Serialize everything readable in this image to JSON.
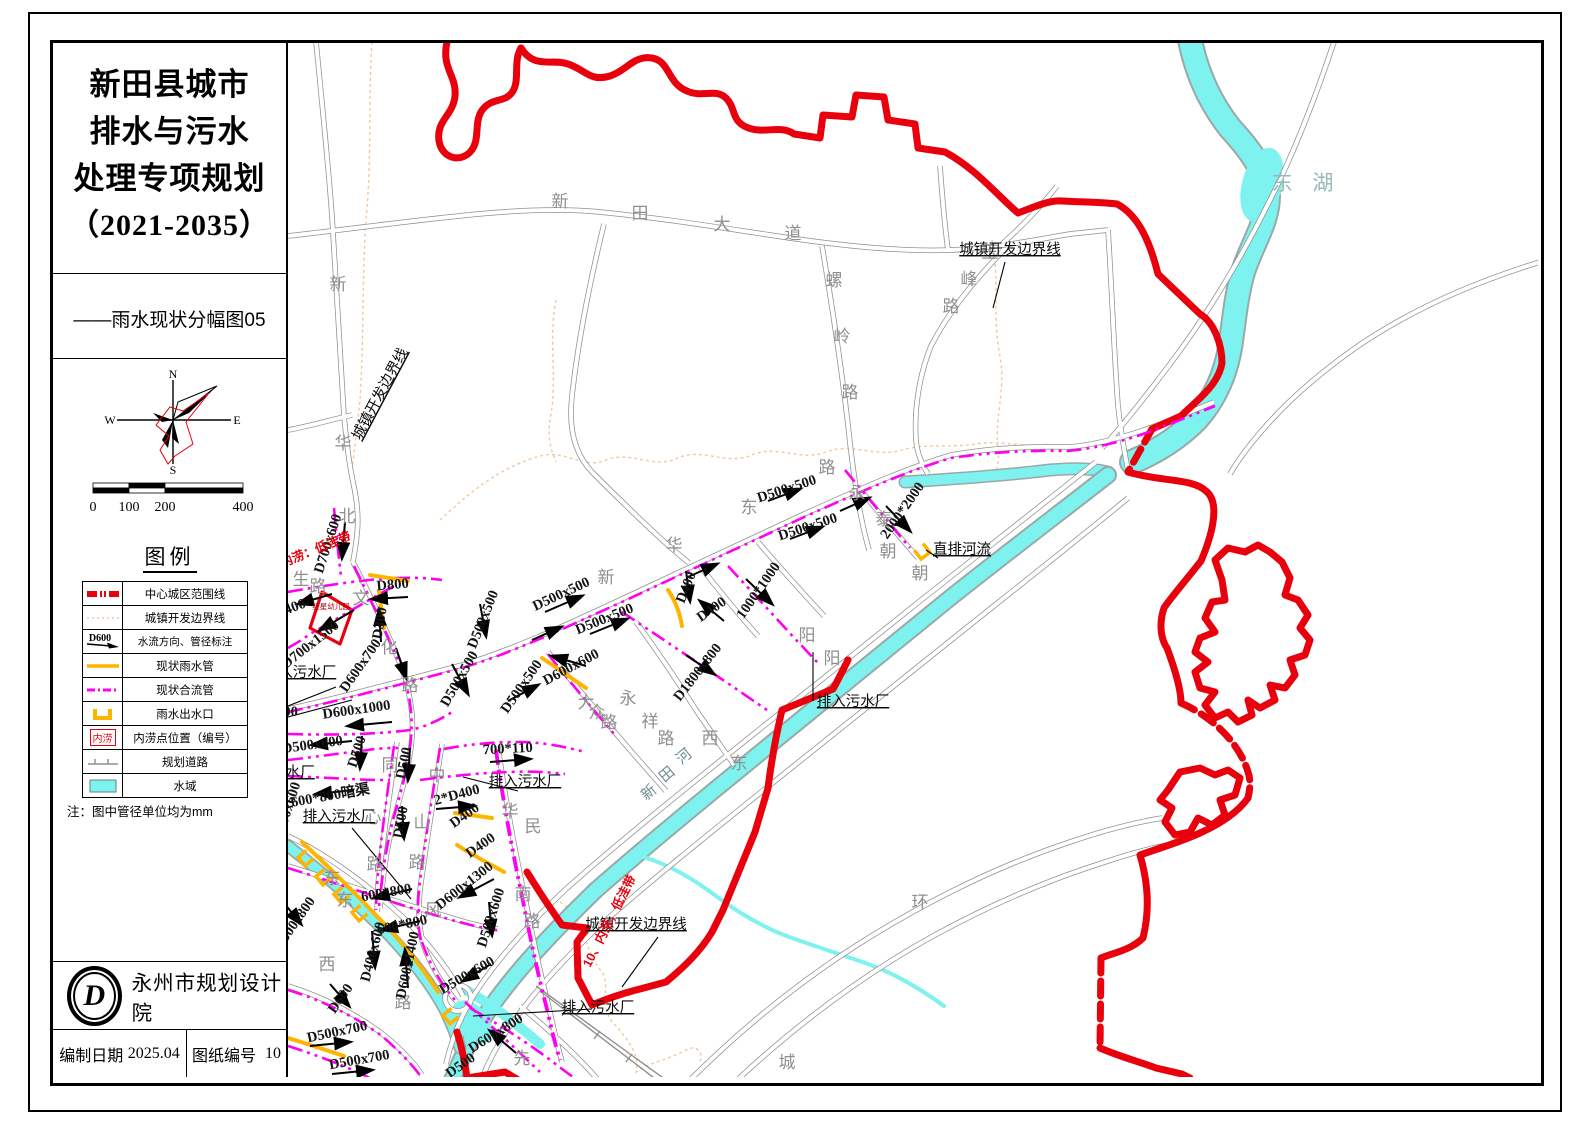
{
  "panel": {
    "title_lines": [
      "新田县城市",
      "排水与污水",
      "处理专项规划",
      "（2021-2035）"
    ],
    "subtitle": "——雨水现状分幅图05",
    "compass": {
      "n": "N",
      "e": "E",
      "s": "S",
      "w": "W"
    },
    "scale": {
      "ticks": [
        "0",
        "100",
        "200",
        "400"
      ]
    },
    "legend": {
      "title": "图例",
      "items": [
        {
          "label": "中心城区范围线",
          "sym": "red-dash"
        },
        {
          "label": "城镇开发边界线",
          "sym": "tan-dot"
        },
        {
          "label": "水流方向、管径标注",
          "sym": "flow",
          "sym_text": "D600"
        },
        {
          "label": "现状雨水管",
          "sym": "rain"
        },
        {
          "label": "现状合流管",
          "sym": "combined"
        },
        {
          "label": "雨水出水口",
          "sym": "outfall"
        },
        {
          "label": "内涝点位置（编号）",
          "sym": "flood",
          "sym_text": "内涝"
        },
        {
          "label": "规划道路",
          "sym": "planned"
        },
        {
          "label": "水域",
          "sym": "water"
        }
      ],
      "note": "注：图中管径单位均为mm"
    },
    "org": "永州市规划设计院",
    "logo_letter": "D",
    "date_label": "编制日期",
    "date_value": "2025.04",
    "sheet_label": "图纸编号",
    "sheet_value": "10"
  },
  "map": {
    "colors": {
      "boundary_red": "#e8000d",
      "combined_pipe": "#ff00f0",
      "rain_pipe": "#ffb400",
      "water": "#7df2ef",
      "road": "#8f8f8f",
      "dev_boundary": "#f0c9a2"
    },
    "labels": [
      {
        "t": "新",
        "x": 560,
        "y": 207,
        "c": "road"
      },
      {
        "t": "田",
        "x": 640,
        "y": 219,
        "c": "road"
      },
      {
        "t": "大",
        "x": 722,
        "y": 230,
        "c": "road"
      },
      {
        "t": "道",
        "x": 793,
        "y": 239,
        "c": "road"
      },
      {
        "t": "螺",
        "x": 834,
        "y": 286,
        "c": "road"
      },
      {
        "t": "岭",
        "x": 842,
        "y": 342,
        "c": "road"
      },
      {
        "t": "路",
        "x": 850,
        "y": 398,
        "c": "road"
      },
      {
        "t": "玉",
        "x": 990,
        "y": 258,
        "c": "road"
      },
      {
        "t": "峰",
        "x": 969,
        "y": 285,
        "c": "road"
      },
      {
        "t": "路",
        "x": 951,
        "y": 312,
        "c": "road"
      },
      {
        "t": "新",
        "x": 338,
        "y": 290,
        "c": "road"
      },
      {
        "t": "华",
        "x": 343,
        "y": 449,
        "c": "road"
      },
      {
        "t": "北",
        "x": 347,
        "y": 522,
        "c": "road"
      },
      {
        "t": "生",
        "x": 301,
        "y": 585,
        "c": "road"
      },
      {
        "t": "路",
        "x": 318,
        "y": 592,
        "c": "road"
      },
      {
        "t": "新",
        "x": 606,
        "y": 583,
        "c": "road"
      },
      {
        "t": "华",
        "x": 674,
        "y": 551,
        "c": "road"
      },
      {
        "t": "东",
        "x": 749,
        "y": 513,
        "c": "road"
      },
      {
        "t": "路",
        "x": 827,
        "y": 473,
        "c": "road"
      },
      {
        "t": "文",
        "x": 361,
        "y": 604,
        "c": "road"
      },
      {
        "t": "化",
        "x": 389,
        "y": 653,
        "c": "road"
      },
      {
        "t": "路",
        "x": 410,
        "y": 691,
        "c": "road"
      },
      {
        "t": "大",
        "x": 586,
        "y": 708,
        "c": "road"
      },
      {
        "t": "众",
        "x": 597,
        "y": 718,
        "c": "road"
      },
      {
        "t": "路",
        "x": 609,
        "y": 728,
        "c": "road"
      },
      {
        "t": "同",
        "x": 390,
        "y": 771,
        "c": "road"
      },
      {
        "t": "心",
        "x": 373,
        "y": 823,
        "c": "road"
      },
      {
        "t": "路",
        "x": 375,
        "y": 870,
        "c": "road"
      },
      {
        "t": "中",
        "x": 437,
        "y": 781,
        "c": "road"
      },
      {
        "t": "山",
        "x": 422,
        "y": 828,
        "c": "road"
      },
      {
        "t": "路",
        "x": 417,
        "y": 868,
        "c": "road"
      },
      {
        "t": "华",
        "x": 510,
        "y": 817,
        "c": "road"
      },
      {
        "t": "民",
        "x": 533,
        "y": 832,
        "c": "road"
      },
      {
        "t": "南",
        "x": 523,
        "y": 900,
        "c": "road"
      },
      {
        "t": "路",
        "x": 532,
        "y": 927,
        "c": "road"
      },
      {
        "t": "永",
        "x": 628,
        "y": 704,
        "c": "road"
      },
      {
        "t": "祥",
        "x": 650,
        "y": 727,
        "c": "road"
      },
      {
        "t": "路",
        "x": 666,
        "y": 744,
        "c": "road"
      },
      {
        "t": "西",
        "x": 710,
        "y": 744,
        "c": "road"
      },
      {
        "t": "东",
        "x": 739,
        "y": 769,
        "c": "road"
      },
      {
        "t": "朝",
        "x": 888,
        "y": 557,
        "c": "road"
      },
      {
        "t": "朝",
        "x": 920,
        "y": 579,
        "c": "road"
      },
      {
        "t": "阳",
        "x": 807,
        "y": 641,
        "c": "road"
      },
      {
        "t": "阳",
        "x": 832,
        "y": 664,
        "c": "road"
      },
      {
        "t": "永",
        "x": 857,
        "y": 499,
        "c": "road"
      },
      {
        "t": "泰",
        "x": 884,
        "y": 525,
        "c": "road"
      },
      {
        "t": "东",
        "x": 345,
        "y": 906,
        "c": "road"
      },
      {
        "t": "风",
        "x": 433,
        "y": 916,
        "c": "road"
      },
      {
        "t": "西",
        "x": 327,
        "y": 970,
        "c": "road"
      },
      {
        "t": "东",
        "x": 332,
        "y": 884,
        "c": "road"
      },
      {
        "t": "环",
        "x": 920,
        "y": 908,
        "c": "road"
      },
      {
        "t": "城",
        "x": 787,
        "y": 1068,
        "c": "road"
      },
      {
        "t": "先",
        "x": 522,
        "y": 1064,
        "c": "road"
      },
      {
        "t": "路",
        "x": 403,
        "y": 1008,
        "c": "road"
      },
      {
        "t": "东 湖",
        "x": 1306,
        "y": 190,
        "c": "lake"
      },
      {
        "t": "新",
        "x": 652,
        "y": 796,
        "r": -40,
        "c": "river"
      },
      {
        "t": "田",
        "x": 670,
        "y": 778,
        "r": -40,
        "c": "river"
      },
      {
        "t": "河",
        "x": 687,
        "y": 760,
        "r": -40,
        "c": "river"
      },
      {
        "t": "D700x600",
        "x": 332,
        "y": 545,
        "r": -72,
        "c": "pipe"
      },
      {
        "t": "D800",
        "x": 393,
        "y": 589,
        "r": -5,
        "c": "pipe"
      },
      {
        "t": "D300",
        "x": 384,
        "y": 624,
        "r": -80,
        "c": "pipe"
      },
      {
        "t": "D700x1500",
        "x": 313,
        "y": 648,
        "r": -38,
        "c": "pipe"
      },
      {
        "t": "x400",
        "x": 293,
        "y": 612,
        "r": -20,
        "c": "pipe"
      },
      {
        "t": "D600x700",
        "x": 364,
        "y": 668,
        "r": -55,
        "c": "pipe"
      },
      {
        "t": "D600x1000",
        "x": 357,
        "y": 714,
        "r": -8,
        "c": "pipe"
      },
      {
        "t": "D500x600",
        "x": 313,
        "y": 749,
        "r": -8,
        "c": "pipe"
      },
      {
        "t": "800",
        "x": 287,
        "y": 716,
        "c": "pipe"
      },
      {
        "t": "600*800暗渠",
        "x": 331,
        "y": 800,
        "r": -10,
        "c": "pipe"
      },
      {
        "t": "D500x600",
        "x": 291,
        "y": 813,
        "r": -72,
        "c": "pipe"
      },
      {
        "t": "D500",
        "x": 361,
        "y": 753,
        "r": -72,
        "c": "pipe"
      },
      {
        "t": "D500",
        "x": 408,
        "y": 764,
        "r": -78,
        "c": "pipe"
      },
      {
        "t": "D500",
        "x": 405,
        "y": 823,
        "r": -80,
        "c": "pipe"
      },
      {
        "t": "D500x500",
        "x": 563,
        "y": 598,
        "r": -25,
        "c": "pipe"
      },
      {
        "t": "D500x500",
        "x": 606,
        "y": 623,
        "r": -22,
        "c": "pipe"
      },
      {
        "t": "D500x500",
        "x": 788,
        "y": 493,
        "r": -18,
        "c": "pipe"
      },
      {
        "t": "D500x500",
        "x": 809,
        "y": 531,
        "r": -18,
        "c": "pipe"
      },
      {
        "t": "D500x500",
        "x": 487,
        "y": 621,
        "r": -68,
        "c": "pipe"
      },
      {
        "t": "D500x500",
        "x": 463,
        "y": 681,
        "r": -60,
        "c": "pipe"
      },
      {
        "t": "D500x500",
        "x": 525,
        "y": 689,
        "r": -55,
        "c": "pipe"
      },
      {
        "t": "D600x600",
        "x": 573,
        "y": 671,
        "r": -28,
        "c": "pipe"
      },
      {
        "t": "D400",
        "x": 690,
        "y": 589,
        "r": -68,
        "c": "pipe"
      },
      {
        "t": "D400",
        "x": 714,
        "y": 613,
        "r": -35,
        "c": "pipe"
      },
      {
        "t": "1000*1000",
        "x": 762,
        "y": 593,
        "r": -55,
        "c": "pipe"
      },
      {
        "t": "D1800x800",
        "x": 701,
        "y": 675,
        "r": -52,
        "c": "pipe"
      },
      {
        "t": "2000*2000",
        "x": 906,
        "y": 513,
        "r": -55,
        "c": "pipe"
      },
      {
        "t": "700*110",
        "x": 508,
        "y": 753,
        "r": -3,
        "c": "pipe"
      },
      {
        "t": "2*D400",
        "x": 458,
        "y": 799,
        "r": -15,
        "c": "pipe"
      },
      {
        "t": "D400",
        "x": 467,
        "y": 819,
        "r": -35,
        "c": "pipe"
      },
      {
        "t": "D400",
        "x": 483,
        "y": 849,
        "r": -35,
        "c": "pipe"
      },
      {
        "t": "D600x1300",
        "x": 467,
        "y": 889,
        "r": -38,
        "c": "pipe"
      },
      {
        "t": "D500x600",
        "x": 495,
        "y": 919,
        "r": -72,
        "c": "pipe"
      },
      {
        "t": "600*800",
        "x": 387,
        "y": 897,
        "r": -10,
        "c": "pipe"
      },
      {
        "t": "600*800",
        "x": 403,
        "y": 929,
        "r": -12,
        "c": "pipe"
      },
      {
        "t": "D400x600",
        "x": 377,
        "y": 953,
        "r": -75,
        "c": "pipe"
      },
      {
        "t": "D600x1400",
        "x": 412,
        "y": 966,
        "r": -78,
        "c": "pipe"
      },
      {
        "t": "D500x800",
        "x": 298,
        "y": 926,
        "r": -55,
        "c": "pipe"
      },
      {
        "t": "D600",
        "x": 344,
        "y": 1001,
        "r": -55,
        "c": "pipe"
      },
      {
        "t": "D500x700",
        "x": 338,
        "y": 1036,
        "r": -12,
        "c": "pipe"
      },
      {
        "t": "D500x700",
        "x": 360,
        "y": 1064,
        "r": -10,
        "c": "pipe"
      },
      {
        "t": "D500x600",
        "x": 469,
        "y": 979,
        "r": -30,
        "c": "pipe"
      },
      {
        "t": "D600x800",
        "x": 498,
        "y": 1037,
        "r": -32,
        "c": "pipe"
      },
      {
        "t": "D500",
        "x": 463,
        "y": 1069,
        "r": -35,
        "c": "pipe"
      },
      {
        "t": "排入污水厂",
        "x": 300,
        "y": 677,
        "c": "ann"
      },
      {
        "t": "污水厂",
        "x": 293,
        "y": 777,
        "c": "ann"
      },
      {
        "t": "排入污水厂",
        "x": 339,
        "y": 821,
        "c": "ann"
      },
      {
        "t": "排入污水厂",
        "x": 525,
        "y": 786,
        "c": "ann"
      },
      {
        "t": "排入污水厂",
        "x": 853,
        "y": 706,
        "c": "ann"
      },
      {
        "t": "排入污水厂",
        "x": 598,
        "y": 1012,
        "c": "ann"
      },
      {
        "t": "城镇开发边界线",
        "x": 1010,
        "y": 254,
        "c": "ann"
      },
      {
        "t": "城镇开发边界线",
        "x": 636,
        "y": 929,
        "c": "ann"
      },
      {
        "t": "城镇开发边界线",
        "x": 384,
        "y": 396,
        "r": -62,
        "c": "ann"
      },
      {
        "t": "直排河流",
        "x": 962,
        "y": 554,
        "c": "ann"
      },
      {
        "t": "9、内涝：低洼带",
        "x": 308,
        "y": 557,
        "r": -22,
        "c": "red"
      },
      {
        "t": "10、内涝，低洼带",
        "x": 613,
        "y": 923,
        "r": -63,
        "c": "red"
      },
      {
        "t": "红星幼儿园",
        "x": 331,
        "y": 609,
        "c": "tiny"
      }
    ]
  }
}
